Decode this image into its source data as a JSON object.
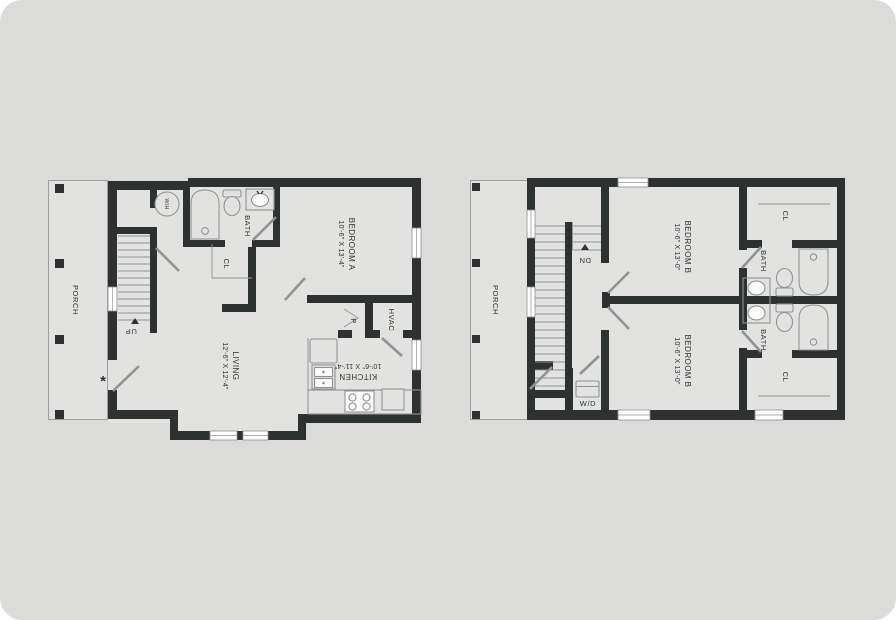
{
  "colors": {
    "page_bg": "#ffffff",
    "card_bg": "#dbdbda",
    "floor": "#e2e2e1",
    "wall": "#2d312f",
    "line": "#8f9492",
    "text": "#2f3331",
    "window_fill": "#ffffff"
  },
  "floor1": {
    "porch_label": "PORCH",
    "stairs_label": "UP",
    "water_heater_label": "W/H",
    "bath_label": "BATH",
    "closet_label": "CL",
    "bedroom": {
      "name": "BEDROOM A",
      "dims": "10'-6\" X 13'-4\""
    },
    "living": {
      "name": "LIVING",
      "dims": "12'-6\" X 12'-4\""
    },
    "kitchen": {
      "name": "KITCHEN",
      "dims": "10'-6\" X 11'-4\""
    },
    "pantry_label": "P",
    "hvac_label": "HVAC",
    "entry_marker": "*"
  },
  "floor2": {
    "porch_label": "PORCH",
    "stairs_label": "DN",
    "bedroom_top": {
      "name": "BEDROOM B",
      "dims": "10'-6\" X 13'-0\""
    },
    "bedroom_bottom": {
      "name": "BEDROOM B",
      "dims": "10'-6\" X 13'-0\""
    },
    "bath_top_label": "BATH",
    "bath_bottom_label": "BATH",
    "closet_top_label": "CL",
    "closet_bottom_label": "CL",
    "laundry_label": "W/D"
  }
}
